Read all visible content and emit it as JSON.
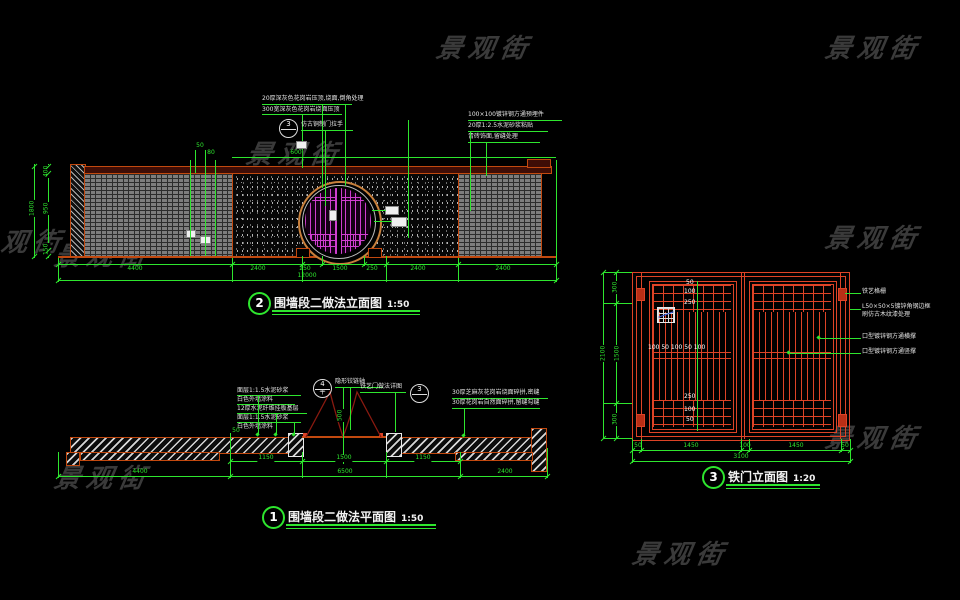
{
  "watermark": "景观街",
  "titles": {
    "elevation": {
      "num": "2",
      "label": "围墙段二做法立面图",
      "scale": "1:50"
    },
    "plan": {
      "num": "1",
      "label": "围墙段二做法平面图",
      "scale": "1:50"
    },
    "gate": {
      "num": "3",
      "label": "铁门立面图",
      "scale": "1:20"
    }
  },
  "elevation": {
    "callout_left_1": "20厚深灰色花岗岩压顶,烧面,倒角处理",
    "callout_left_2": "300宽深灰色花岗岩烧面压顶",
    "bubble": "3",
    "callout_handle": "仿古铜制门拉手",
    "callout_right_1": "100×100镀锌钢方通预埋件",
    "callout_right_2": "20厚1:2.5水泥砂浆粘贴",
    "callout_right_3": "青砖饰面,留缝处理",
    "dim_600": "600",
    "dim_50": "50",
    "dim_80": "80",
    "dims_bottom": [
      "4400",
      "2400",
      "250",
      "1500",
      "250",
      "2400",
      "2400"
    ],
    "dim_total": "12000",
    "dims_left": [
      "400",
      "950",
      "150"
    ],
    "dim_left_total": "1800"
  },
  "plan": {
    "callouts_left": [
      "面层1:1.5水泥砂浆",
      "白色外墙涂料",
      "12厚水泥纤维挂板基层",
      "面层1:1.5水泥砂浆",
      "白色外墙涂料"
    ],
    "callout_hinge": "隐形铰链轴",
    "bubble4": "4",
    "bubble4_sub": "平",
    "callout_detail": "铁艺门做法详图",
    "bubble3": "3",
    "callout_right_1": "30厚芝麻灰花岗岩烧面碎拼,密缝",
    "callout_right_2": "30厚花岗岩自然面碎拼,留缝勾缝",
    "dim_50": "50",
    "dim_opening": "500",
    "dims_row1": [
      "1150",
      "1500",
      "1150"
    ],
    "dims_row2": [
      "4400",
      "6500",
      "2400"
    ]
  },
  "gate": {
    "dims_left": [
      "300",
      "1500",
      "300"
    ],
    "dim_left_total": "2100",
    "dims_bottom": [
      "50",
      "1450",
      "100",
      "1450",
      "50"
    ],
    "dim_bottom_total": "3100",
    "ann_1": "铁艺格栅",
    "ann_2": "L50×50×5镀锌角钢边框",
    "ann_3": "刷仿古木纹漆处理",
    "ann_4": "口型镀锌钢方通横撑",
    "ann_5": "口型镀锌钢方通竖撑",
    "mid_dims": "100 50 100 50 100",
    "v_dims_top": [
      "50",
      "100",
      "250"
    ],
    "v_dims_bottom": [
      "250",
      "100",
      "50"
    ]
  },
  "colors": {
    "dim_green": "#2ee62e",
    "wall_orange": "#c2490f",
    "gate_red": "#dd4326",
    "door_magenta": "#cf3ecf"
  }
}
